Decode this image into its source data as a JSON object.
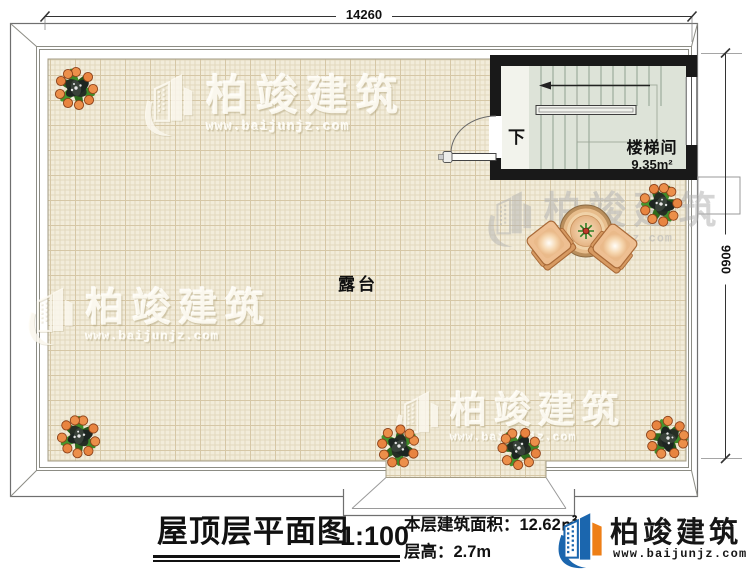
{
  "colors": {
    "brand-blue": "#1b66ae",
    "brand-orange": "#ee7f17",
    "tile": "#f2ecda",
    "tile-grid": "#e2d8bd",
    "wall": "#191919",
    "stair-floor": "#e2e6df",
    "plan-line": "#6f6f6f"
  },
  "dimensions": {
    "top": "14260",
    "right": "9060"
  },
  "plan": {
    "terrace_label": "露台",
    "stairwell": {
      "name": "楼梯间",
      "area": "9.35m²",
      "direction": "下"
    }
  },
  "watermark": {
    "brand": "柏竣建筑",
    "url": "www.baijunjz.com"
  },
  "title_block": {
    "title": "屋顶层平面图",
    "scale": "1:100",
    "floor_area": "本层建筑面积：12.62㎡",
    "floor_height": "层高：2.7m"
  },
  "brand": {
    "name": "柏竣建筑",
    "url": "www.baijunjz.com"
  }
}
